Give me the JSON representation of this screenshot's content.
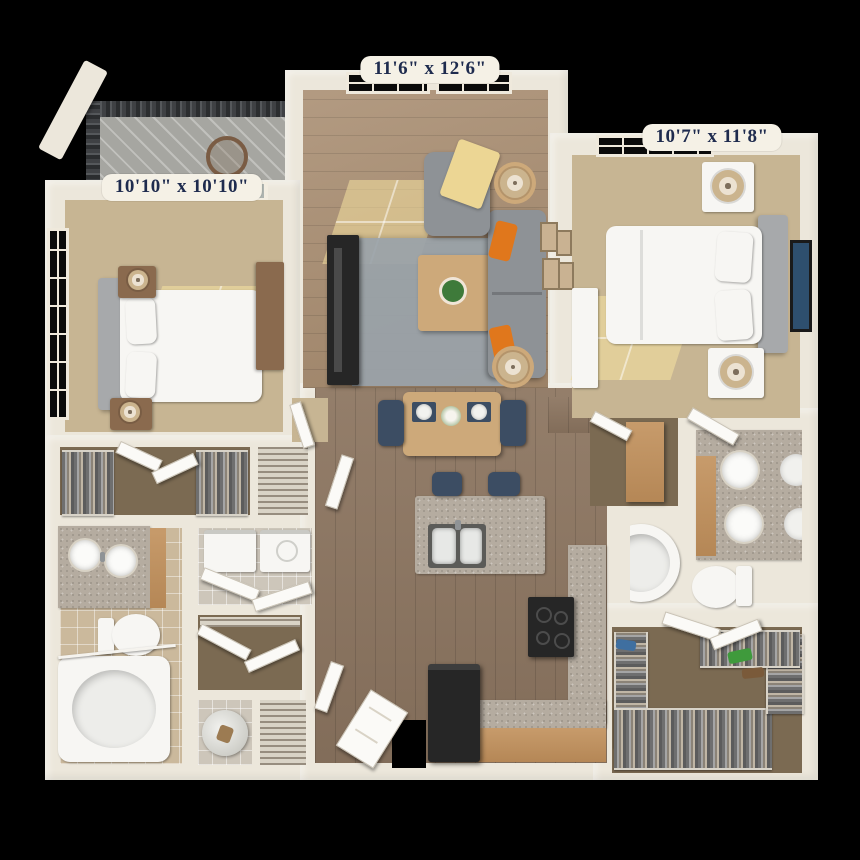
{
  "rooms": [
    {
      "name": "living-room",
      "dimensions": "11'6\" x 12'6\""
    },
    {
      "name": "bedroom-right",
      "dimensions": "10'7\" x 11'8\""
    },
    {
      "name": "bedroom-left",
      "dimensions": "10'10\" x 10'10\""
    }
  ],
  "colors": {
    "background": "#000000",
    "wall": "#ece7db",
    "wall_shade": "#d9d2c3",
    "label_bg": "#f5f1e6",
    "label_text": "#1e2b4e",
    "wood": "#8d7661",
    "wood_light": "#a68a6d",
    "carpet": "#c7b593",
    "closet_carpet": "#7b6a52",
    "tile": "#cbb99c",
    "granite": "#b5aca0",
    "cabinet_wood": "#c79b6b",
    "nightstand_wood": "#8a6a4e",
    "rug": "#9aa3aa",
    "sofa": "#8e9296",
    "pillow_orange": "#e0771c",
    "throw_yellow": "#ecd694",
    "navy_chair": "#3c4d63",
    "appliance_dark": "#262626",
    "fixture_white": "#f7f6f3",
    "deck": "#a6a6a1",
    "railing": "#3f4144",
    "table_wood": "#cda97a",
    "plant_green": "#3e7a3a",
    "art_blue": "#2e4f6e",
    "lamp_tan": "#cbb48e"
  }
}
